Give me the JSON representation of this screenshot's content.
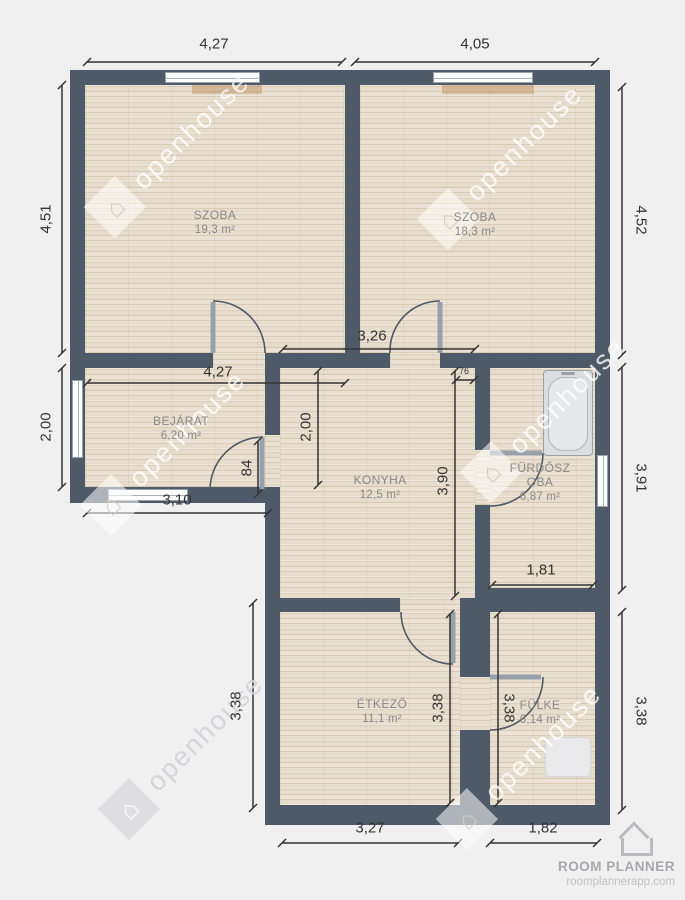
{
  "watermark": {
    "text": "openhouse"
  },
  "branding": {
    "name": "ROOM PLANNER",
    "url": "roomplannerapp.com"
  },
  "rooms": [
    {
      "id": "szoba-1",
      "name": "SZOBA",
      "area": "19,3 m²"
    },
    {
      "id": "szoba-2",
      "name": "SZOBA",
      "area": "18,3 m²"
    },
    {
      "id": "bejarat",
      "name": "BEJÁRAT",
      "area": "6,20 m²"
    },
    {
      "id": "konyha",
      "name": "KONYHA",
      "area": "12,5 m²"
    },
    {
      "id": "furdoszoba",
      "name": "FÜRDŐSZOBA",
      "area": "6,87 m²"
    },
    {
      "id": "etkezo",
      "name": "ÉTKEZŐ",
      "area": "11,1 m²"
    },
    {
      "id": "fulke",
      "name": "FÜLKE",
      "area": "6,14 m²"
    }
  ],
  "dimensions": {
    "top_left": "4,27",
    "top_right": "4,05",
    "left_upper": "4,51",
    "left_entry": "2,00",
    "left_dining": "3,38",
    "right_upper": "4,52",
    "right_middle": "3,91",
    "right_lower": "3,38",
    "bottom_dining": "3,27",
    "bottom_nook": "1,82",
    "entry_top": "4,27",
    "entry_bottom": "3,10",
    "entry_door": "84",
    "kitchen_top": "3,26",
    "kitchen_left": "2,00",
    "kitchen_right": "3,90",
    "bath_door": "76",
    "bath_bottom": "1,81",
    "dining_right": "3,38",
    "nook_left": "3,38"
  },
  "colors": {
    "wall": "#4e5a68",
    "floor": "#e7ddcd",
    "background": "#f0f0f1",
    "dimension_text": "#333333",
    "room_label": "#8a8a8a"
  }
}
